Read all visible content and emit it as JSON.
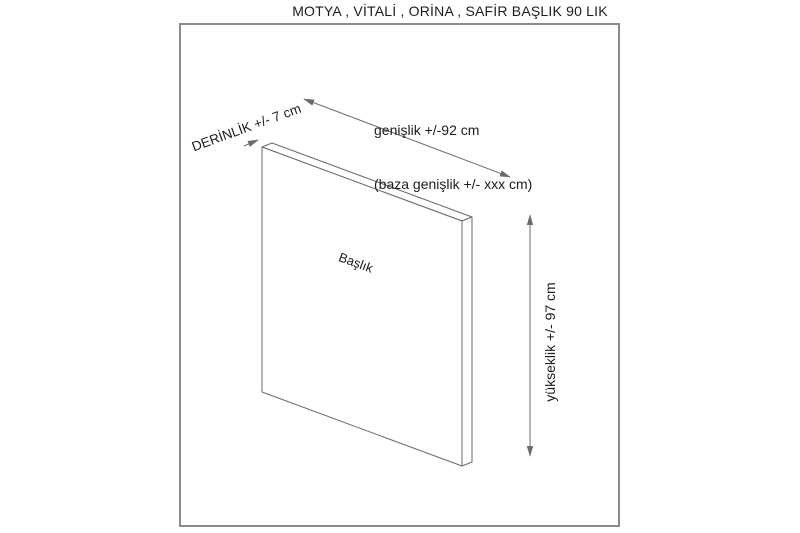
{
  "title": "MOTYA , VİTALİ , ORİNA , SAFİR BAŞLIK 90 LIK",
  "panel": {
    "label": "Başlık"
  },
  "dimensions": {
    "width": {
      "line1": "genişlik +/-92 cm",
      "line2": "(baza genişlik +/- xxx cm)"
    },
    "depth": {
      "label": "DERİNLİK +/- 7 cm"
    },
    "height": {
      "label": "yükseklik +/- 97 cm"
    }
  },
  "colors": {
    "background": "#ffffff",
    "text": "#1c1c1c",
    "line": "#6a6a6a",
    "frame": "#8a8a8a"
  }
}
